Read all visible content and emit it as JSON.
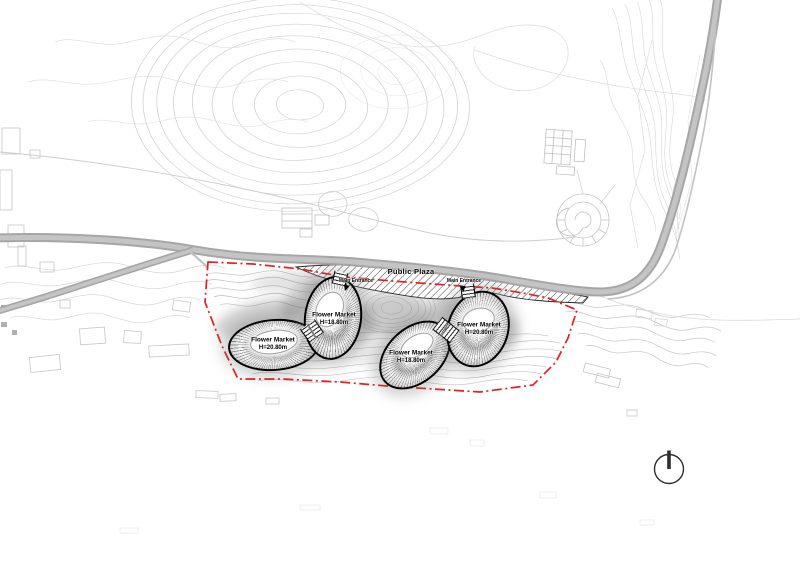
{
  "plaza": {
    "label": "Public Plaza"
  },
  "entrances": [
    {
      "label": "Main Entrance"
    },
    {
      "label": "Main Entrance"
    }
  ],
  "buildings": [
    {
      "id": "west",
      "label": "Flower Market",
      "height": "H=20.80m"
    },
    {
      "id": "north",
      "label": "Flower Market",
      "height": "H=18.80m"
    },
    {
      "id": "south",
      "label": "Flower Market",
      "height": "H=18.80m"
    },
    {
      "id": "east",
      "label": "Flower Market",
      "height": "H=20.80m"
    }
  ],
  "connectors": [
    {
      "label": "Entrance"
    },
    {
      "label": "Entrance"
    }
  ],
  "colors": {
    "site_boundary": "#e51f1f",
    "road": "#a8a8a8",
    "building_outline": "#000000",
    "hatch": "#2e2e2e"
  }
}
